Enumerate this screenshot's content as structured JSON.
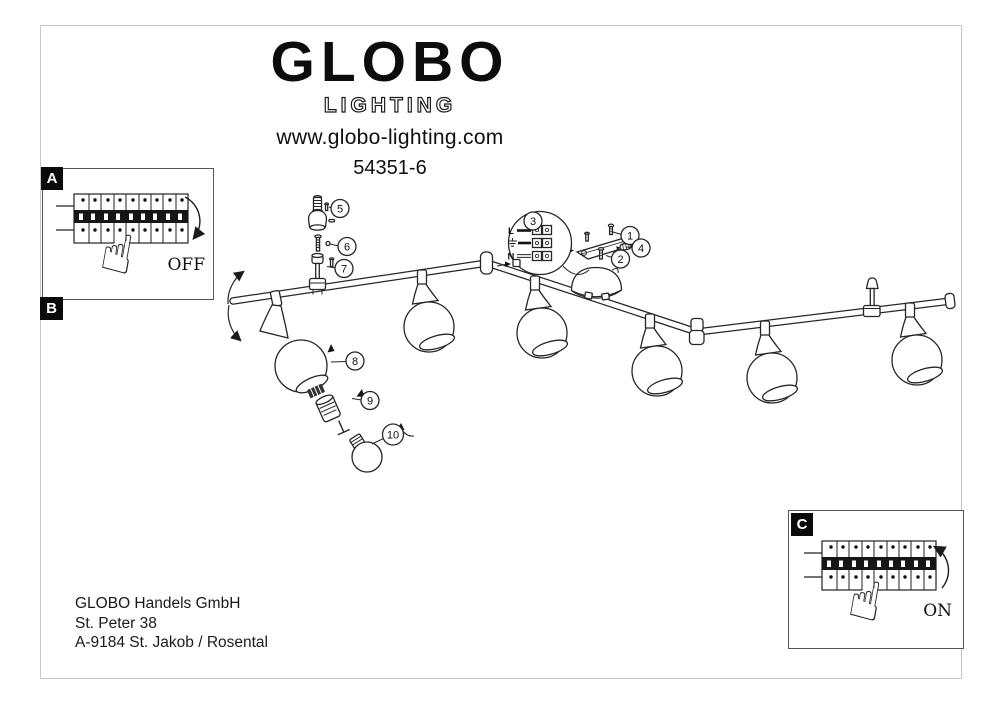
{
  "header": {
    "brand": "GLOBO",
    "brand_sub": "LIGHTING",
    "website": "www.globo-lighting.com",
    "model": "54351-6"
  },
  "steps": {
    "a_label": "A",
    "b_label": "B",
    "c_label": "C",
    "off_label": "OFF",
    "on_label": "ON"
  },
  "diagram": {
    "callout_numbers": [
      "1",
      "2",
      "3",
      "4",
      "5",
      "6",
      "7",
      "8",
      "9",
      "10"
    ],
    "wiring": {
      "live_label": "L",
      "neutral_label": "N"
    }
  },
  "footer": {
    "company": "GLOBO Handels GmbH",
    "street": "St. Peter 38",
    "city": "A-9184 St. Jakob / Rosental"
  },
  "colors": {
    "ink": "#262626",
    "page_border": "#c6c6c6",
    "tag_bg": "#0a0a0a"
  }
}
